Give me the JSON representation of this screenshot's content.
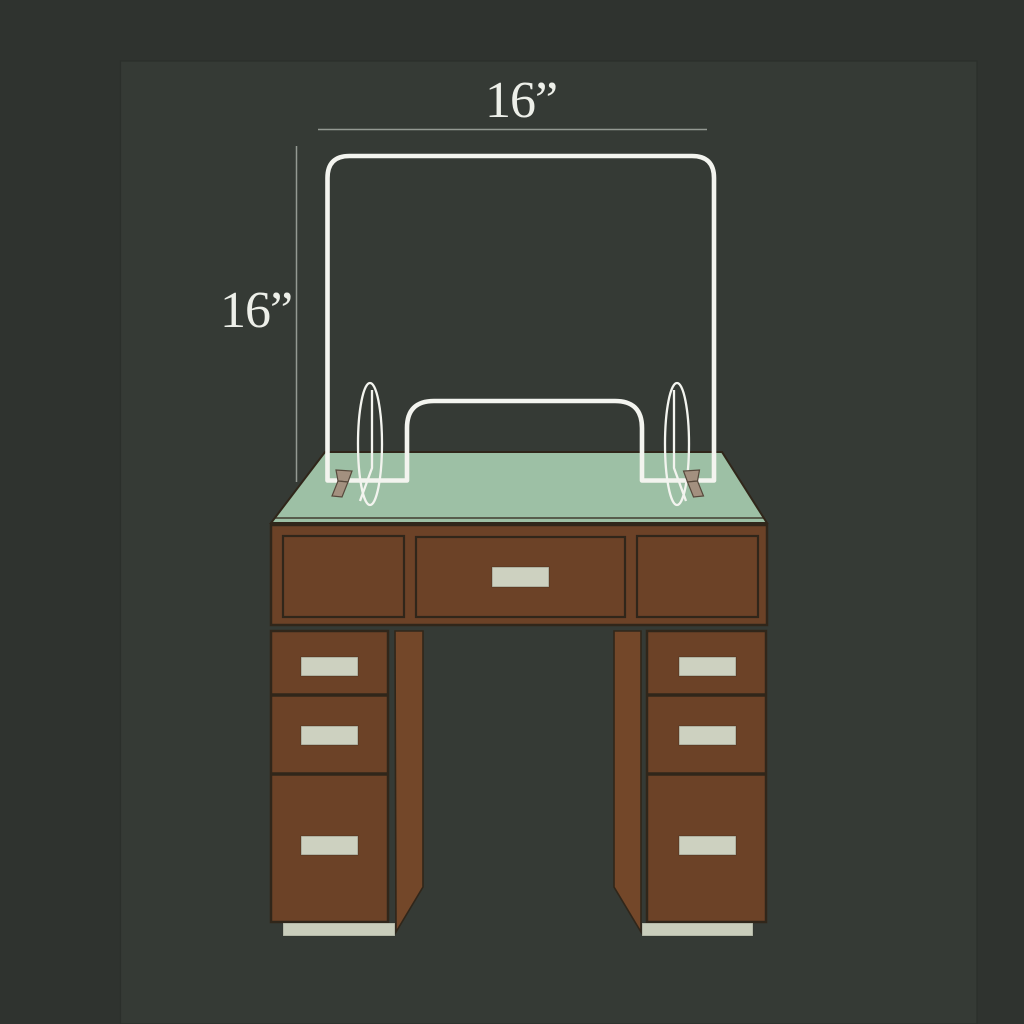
{
  "illustration": {
    "subject": "acrylic sneeze-guard shield mounted on a wooden pedestal desk",
    "width_dimension_label": "16”",
    "height_dimension_label": "16”"
  },
  "colors": {
    "bg": "#2f332f",
    "card": "#353a35",
    "card-seam": "#2b2f2b",
    "wood": "#6c4227",
    "wood-side": "#734729",
    "wood-outline": "#30261a",
    "desk-top": "#9dc0a5",
    "handle": "#cdd1c0",
    "foot": "#c9cdbb",
    "shield": "#f3f4ef",
    "bracket": "#a3907f",
    "bracket-outline": "#57493c",
    "dim-line": "#949993",
    "label-text": "#edefe9"
  }
}
